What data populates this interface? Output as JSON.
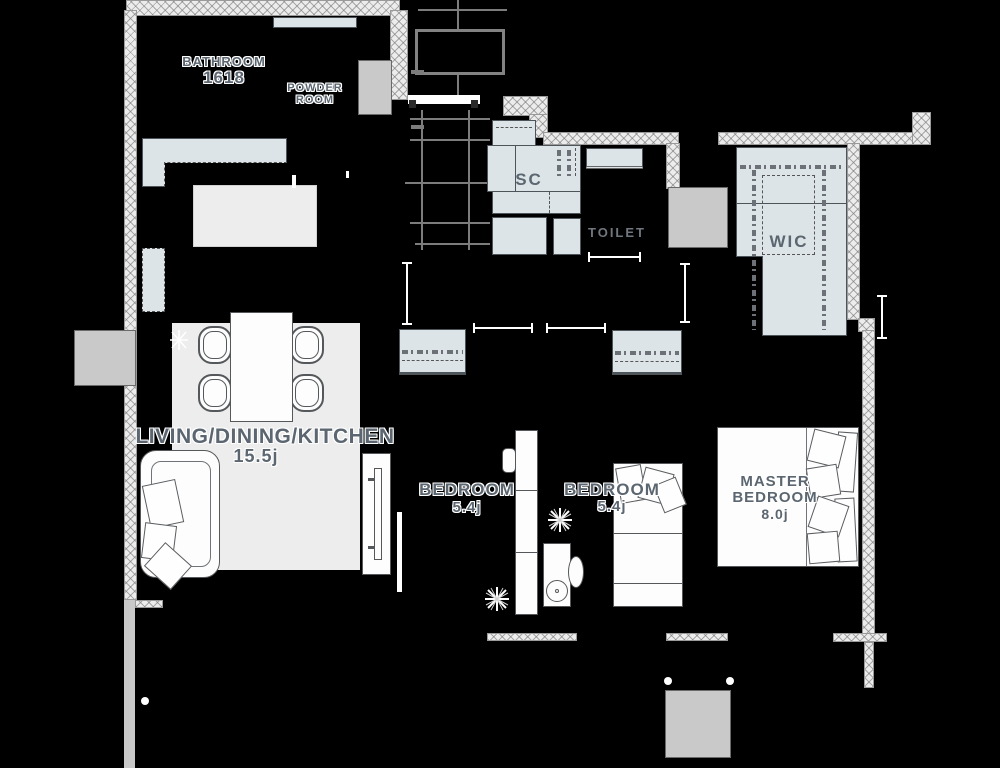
{
  "title": "apartment-floor-plan",
  "labels": {
    "bathroom": {
      "name": "BATHROOM",
      "size": "1618"
    },
    "powder": {
      "line1": "POWDER",
      "line2": "ROOM"
    },
    "sc": {
      "name": "SC"
    },
    "toilet": {
      "name": "TOILET"
    },
    "wic": {
      "name": "WIC"
    },
    "ldk": {
      "name": "LIVING/DINING/KITCHEN",
      "size": "15.5j"
    },
    "bedroom1": {
      "name": "BEDROOM",
      "size": "5.4j"
    },
    "bedroom2": {
      "name": "BEDROOM",
      "size": "5.4j"
    },
    "master": {
      "line1": "MASTER",
      "line2": "BEDROOM",
      "size": "8.0j"
    }
  },
  "colors": {
    "background": "#000000",
    "wall_fill": "#ececec",
    "wall_hatch": "#6e6e6e",
    "fixture_fill": "#dce4e7",
    "rug_fill": "#ededed",
    "furniture_fill": "#fdfdfd",
    "concrete_fill": "#c9c9c9",
    "label_text": "#5b6670",
    "label_halo": "#ffffff"
  }
}
